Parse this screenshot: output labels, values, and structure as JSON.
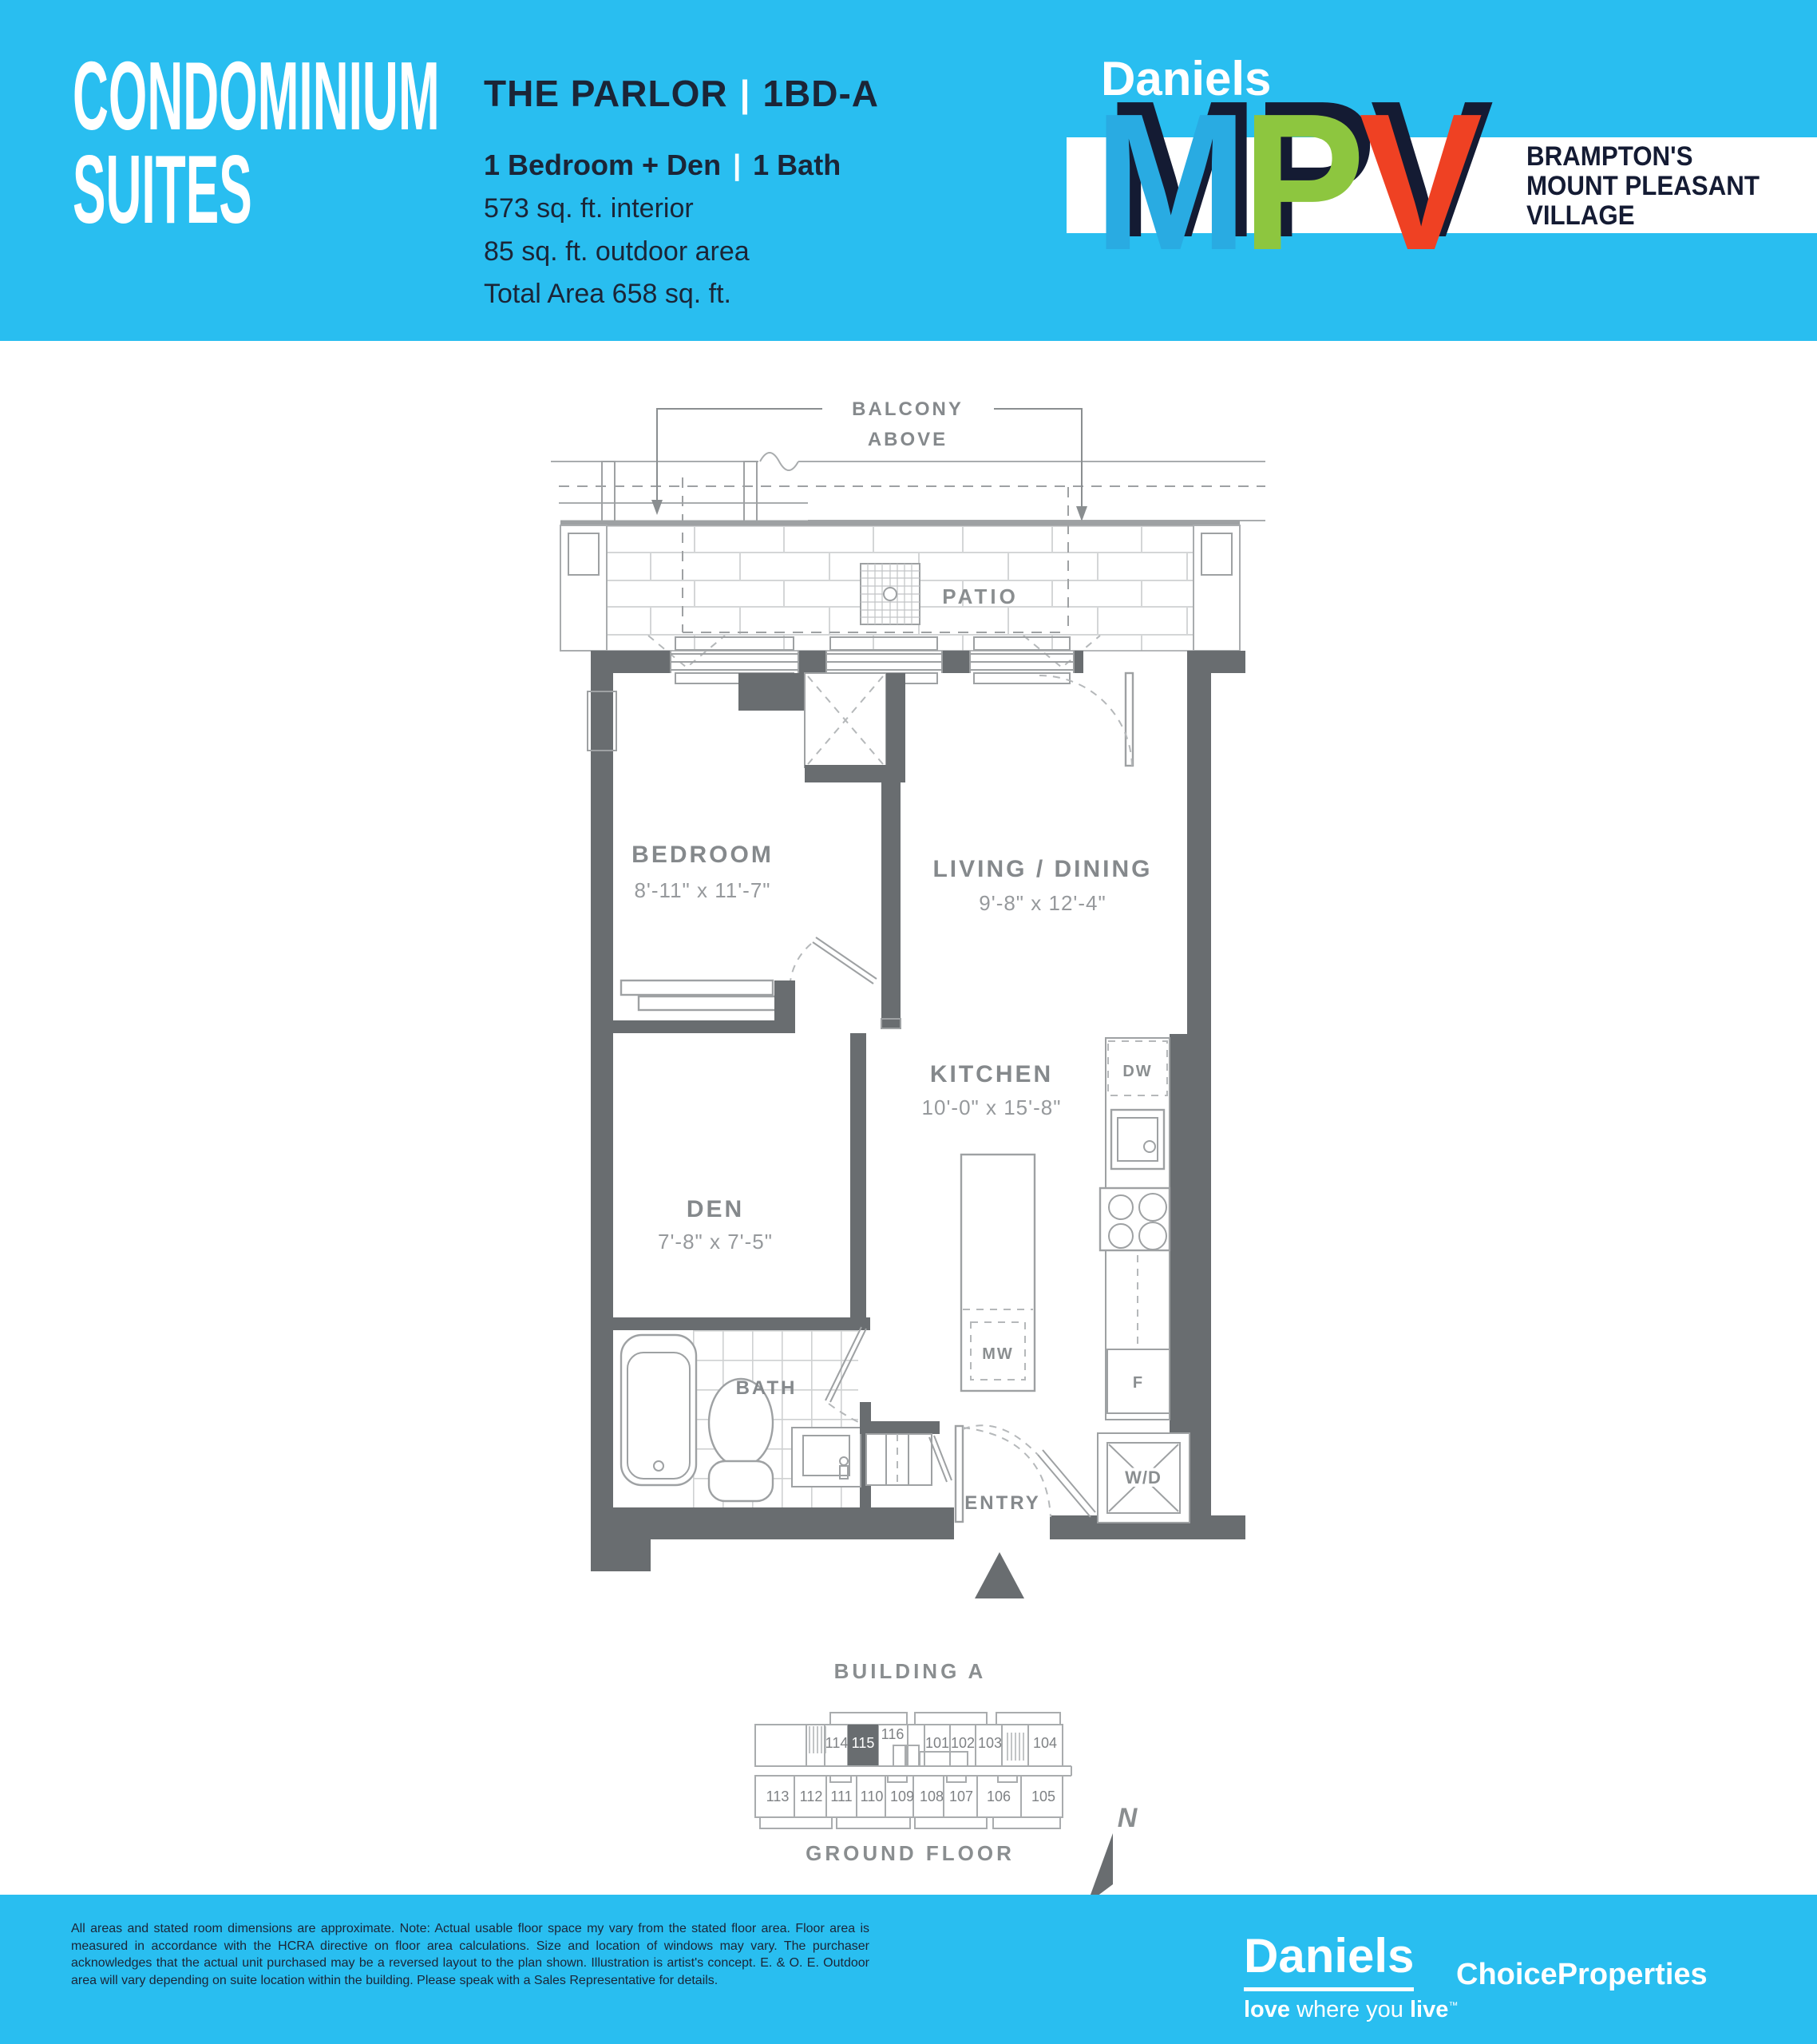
{
  "colors": {
    "cyan": "#29BEF0",
    "navy": "#1B2537",
    "logo_navy": "#141B33",
    "logo_blue": "#29ABE2",
    "logo_green": "#8DC63F",
    "logo_red": "#EF4123",
    "wall_gray": "#696D70",
    "label_gray": "#85898C"
  },
  "header": {
    "suite_line1": "CONDOMINIUM",
    "suite_line2": "SUITES",
    "plan_name": "THE PARLOR",
    "separator": "|",
    "plan_code": "1BD-A",
    "feature_left": "1 Bedroom + Den",
    "feature_right": "1 Bath",
    "interior": "573 sq. ft. interior",
    "outdoor": "85 sq. ft. outdoor area",
    "total": "Total Area 658 sq. ft.",
    "logo": {
      "brand": "Daniels",
      "m": "M",
      "p": "P",
      "v": "V",
      "mpv": "MPV",
      "tagline_line1": "BRAMPTON'S",
      "tagline_line2": "MOUNT PLEASANT",
      "tagline_line3": "VILLAGE"
    }
  },
  "plan": {
    "balcony_line1": "BALCONY",
    "balcony_line2": "ABOVE",
    "patio": "PATIO",
    "rooms": {
      "bedroom": {
        "name": "BEDROOM",
        "dims": "8'-11\" x 11'-7\""
      },
      "living": {
        "name": "LIVING / DINING",
        "dims": "9'-8\" x 12'-4\""
      },
      "kitchen": {
        "name": "KITCHEN",
        "dims": "10'-0\" x 15'-8\""
      },
      "den": {
        "name": "DEN",
        "dims": "7'-8\" x 7'-5\""
      },
      "bath": "BATH",
      "entry": "ENTRY"
    },
    "appliances": {
      "dw": "DW",
      "mw": "MW",
      "fridge": "F",
      "wd": "W/D"
    }
  },
  "keyplan": {
    "title": "BUILDING A",
    "floor": "GROUND FLOOR",
    "north": "N",
    "highlighted_unit": "115",
    "top_units": [
      "114",
      "115",
      "116",
      "101",
      "102",
      "103",
      "104"
    ],
    "bottom_units": [
      "113",
      "112",
      "111",
      "110",
      "109",
      "108",
      "107",
      "106",
      "105"
    ]
  },
  "footer": {
    "disclaimer": "All areas and stated room dimensions are approximate. Note: Actual usable floor space my vary from the stated floor area. Floor area is measured in accordance with the HCRA directive on floor area calculations. Size and location of windows may vary. The purchaser acknowledges that the actual unit purchased may be a reversed layout to the plan shown. Illustration is artist's concept. E. & O. E. Outdoor area will vary depending on suite location within the building. Please speak with a Sales Representative for details.",
    "daniels": "Daniels",
    "tag_love": "love",
    "tag_mid": " where you ",
    "tag_live": "live",
    "tm": "™",
    "choice": "ChoiceProperties"
  }
}
